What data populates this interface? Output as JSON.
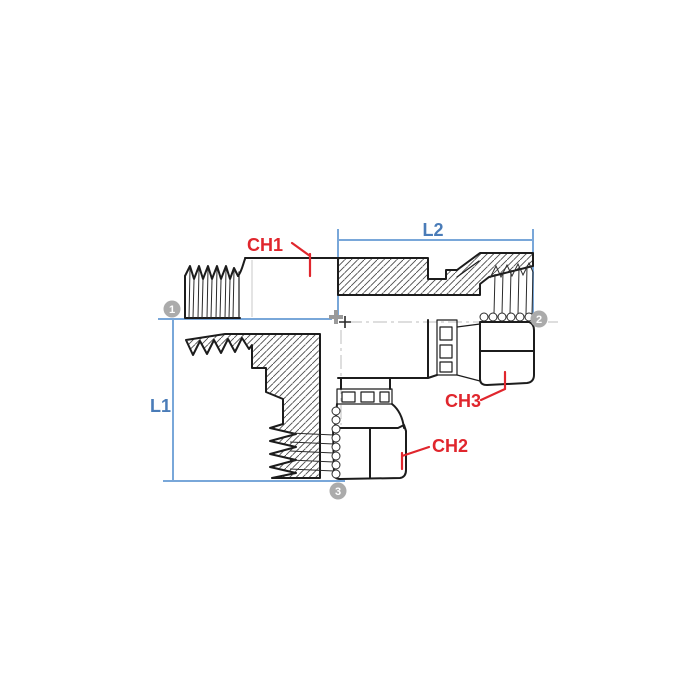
{
  "drawing": {
    "type": "technical-drawing",
    "subject": "tee swivel hydraulic fitting cross-section",
    "dimension_labels": {
      "l1": "L1",
      "l2": "L2"
    },
    "chamfer_labels": {
      "ch1": "CH1",
      "ch2": "CH2",
      "ch3": "CH3"
    },
    "port_markers": [
      {
        "id": "1"
      },
      {
        "id": "2"
      },
      {
        "id": "3"
      }
    ],
    "colors": {
      "background": "#ffffff",
      "line": "#1c1c1c",
      "dimension_line": "#79a7d9",
      "dimension_text": "#4a7cb8",
      "label_red": "#e0262d",
      "marker_gray": "#ababab",
      "marker_text": "#ffffff",
      "centerline_gray": "#bcbcbc"
    }
  }
}
